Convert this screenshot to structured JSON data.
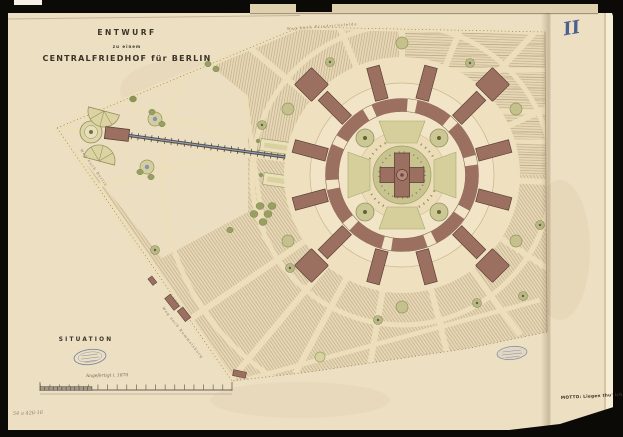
{
  "document": {
    "background_color": "#0c0a07",
    "paper_color": "#ecdfc2",
    "title": {
      "line1": "ENTWURF",
      "line2": "zu einem",
      "line3": "CENTRALFRIEDHOF für BERLIN"
    },
    "plate_number": "II",
    "section_label": "SITUATION",
    "handwritten_note": "Angefertigt i. 1870",
    "motto": "MOTTO: Liegen thu' ich nicht",
    "shelfmark": "54 a 426-16"
  },
  "map": {
    "site_color": "#e7d7b4",
    "building_color": "#9c7060",
    "garden_color": "#c9c390",
    "railway_color": "#8fa0be",
    "stamp_color": "#7b87a4",
    "road_labels": [
      {
        "text": "Weg nach Friedrichsfelde"
      },
      {
        "text": "Weg nach Berlin"
      },
      {
        "text": "Weg nach Rummelsburg"
      },
      {
        "text": "Eisenbahn"
      }
    ]
  }
}
